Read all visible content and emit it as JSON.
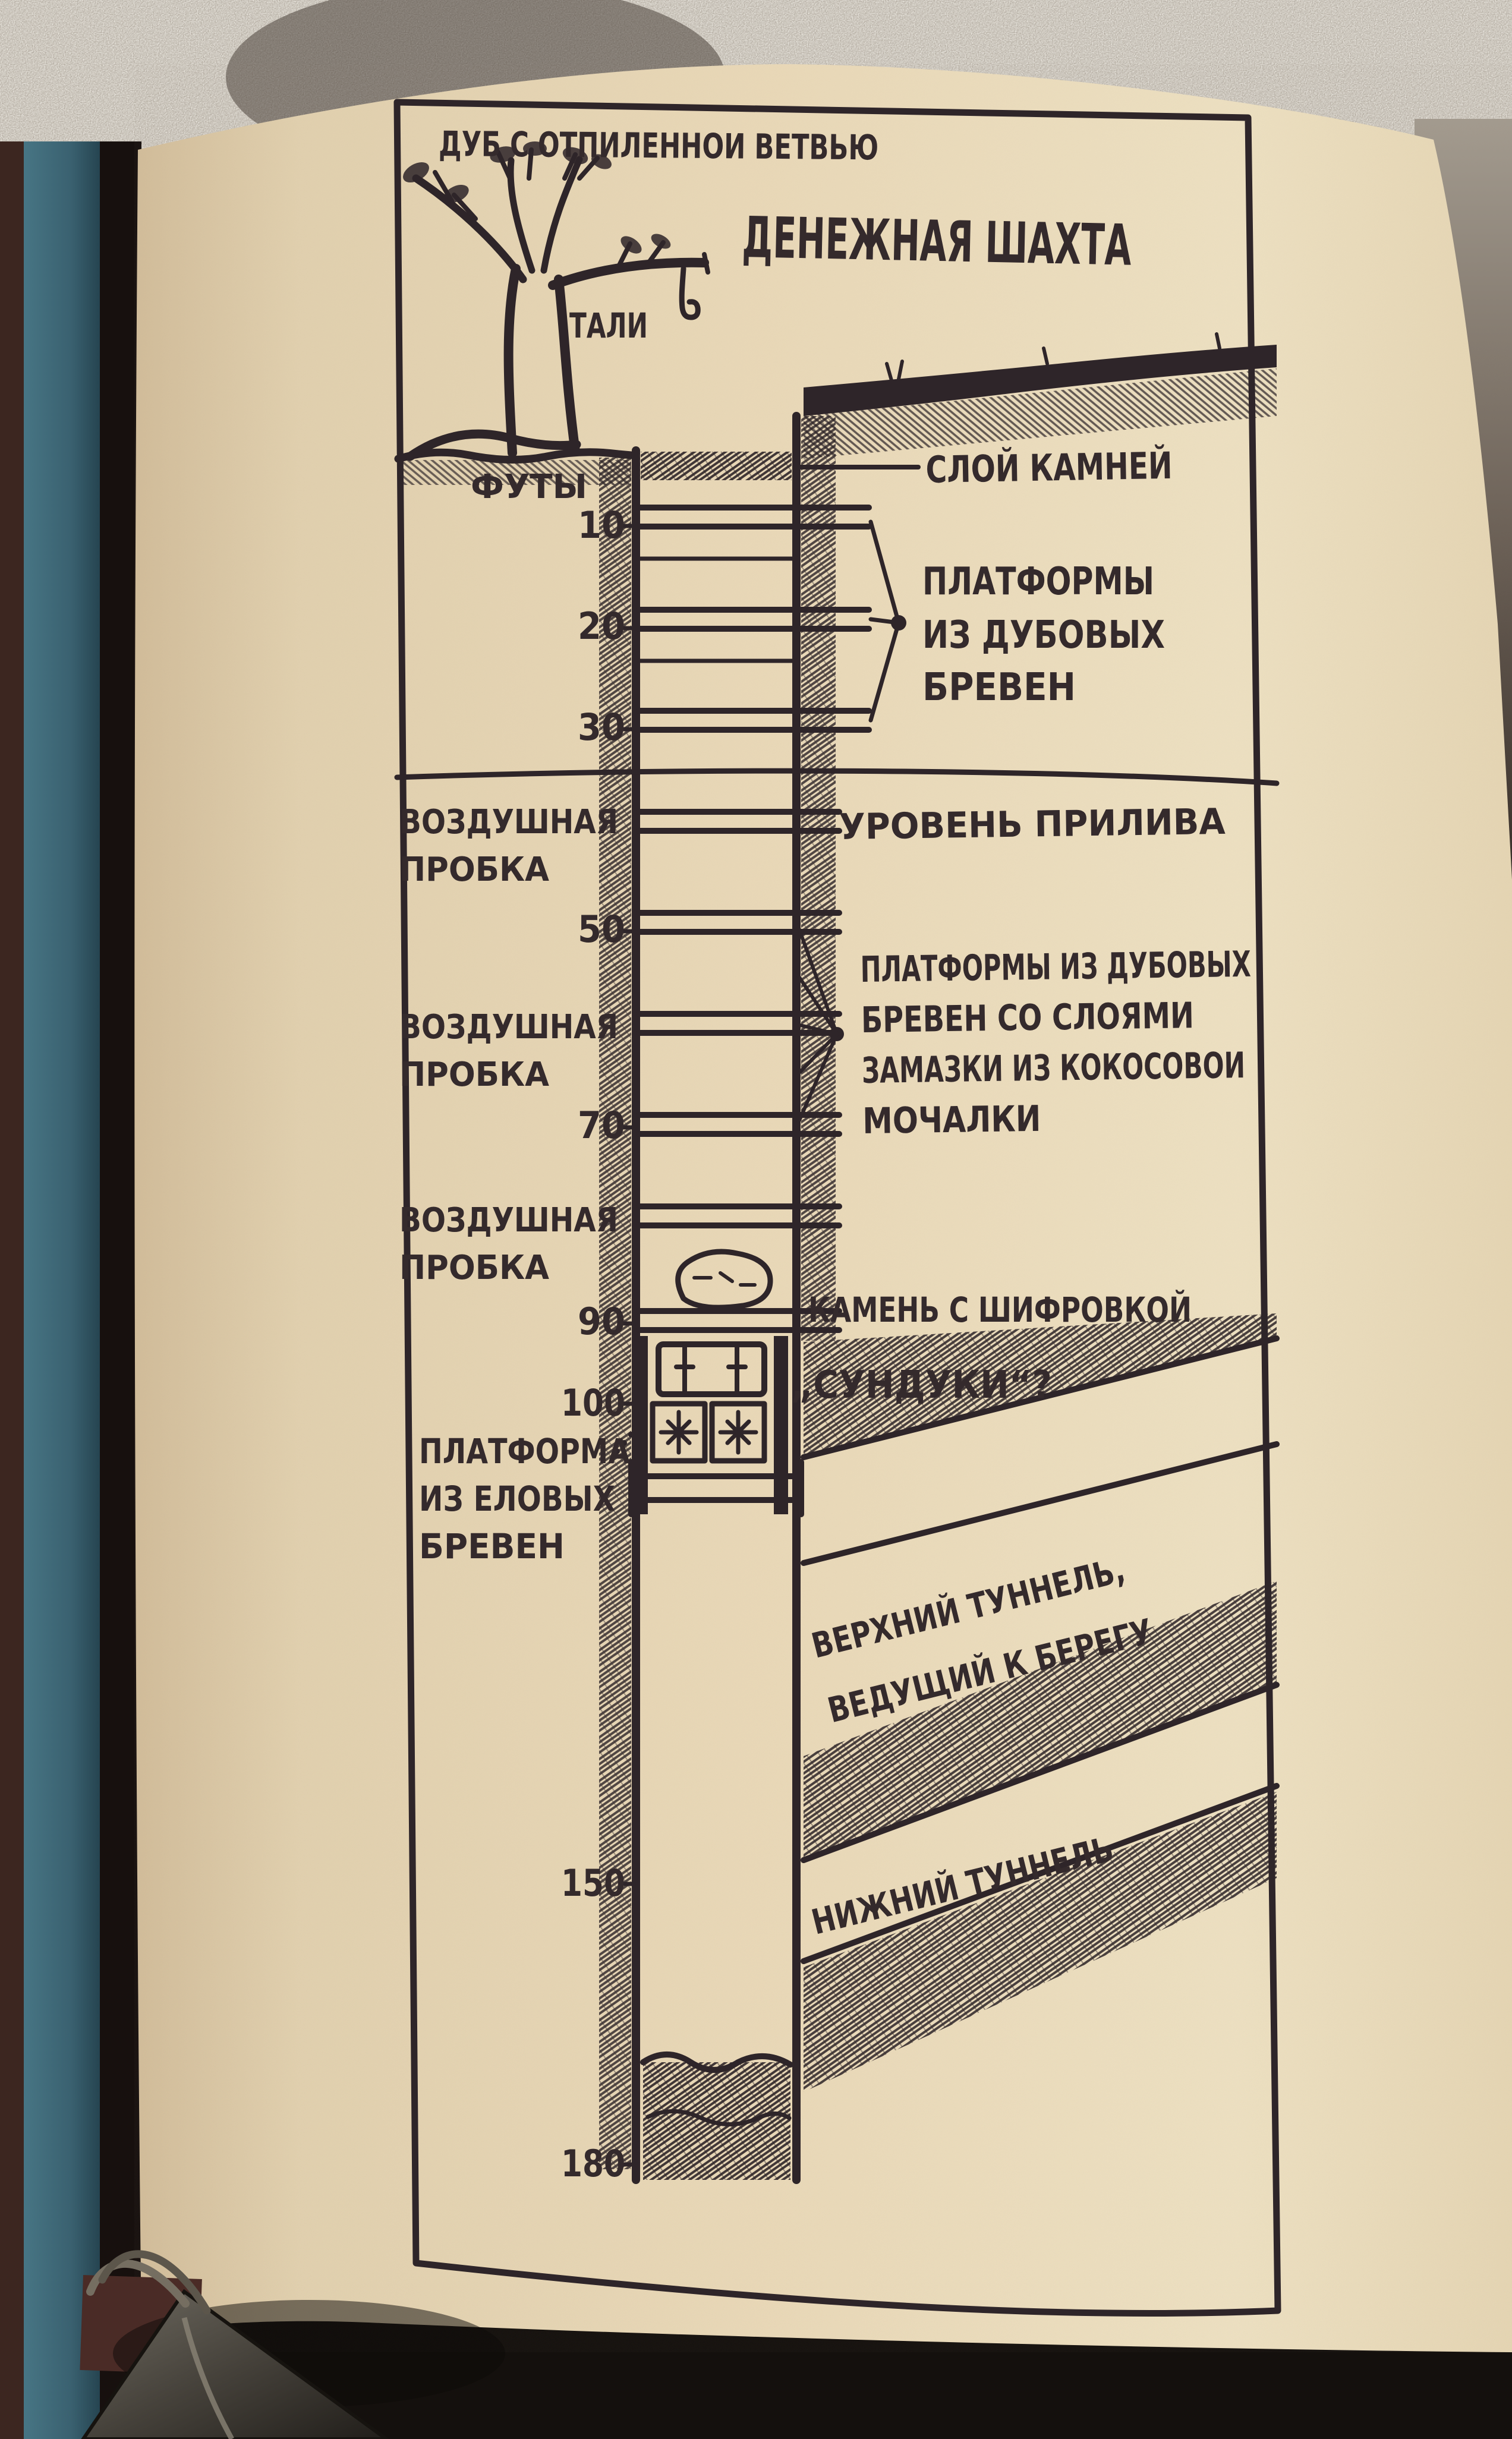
{
  "photo": {
    "backdrop_glitter": "#b5aea3",
    "backdrop_dark": "#1a1310",
    "cover_teal_light": "#477584",
    "cover_teal_dark": "#2a4c58",
    "cover_maroon": "#3c2620",
    "page_light": "#efe2c3",
    "page_mid": "#e7d8b7",
    "page_shadow": "#d2bd9a",
    "ink": "#2e2529",
    "clip_metal": "#555047"
  },
  "diagram": {
    "tree_label": "ДУБ С ОТПИЛЕННОИ ВЕТВЬЮ",
    "title": "ДЕНЕЖНАЯ ШАХТА",
    "tackle_label": "ТАЛИ",
    "feet_label": "ФУТЫ",
    "depth_ticks": [
      "10",
      "20",
      "30",
      "50",
      "70",
      "90",
      "100",
      "150",
      "180"
    ],
    "stone_layer_label": "СЛОЙ КАМНЕЙ",
    "oak_platforms_label": [
      "ПЛАТФОРМЫ",
      "ИЗ ДУБОВЫХ",
      "БРЕВЕН"
    ],
    "tide_level_label": "УРОВЕНЬ ПРИЛИВА",
    "air_pocket_label": [
      "ВОЗДУШНАЯ",
      "ПРОБКА"
    ],
    "putty_platforms_label": [
      "ПЛАТФОРМЫ ИЗ ДУБОВЫХ",
      "БРЕВЕН СО СЛОЯМИ",
      "ЗАМАЗКИ ИЗ КОКОСОВОИ",
      "МОЧАЛКИ"
    ],
    "cipher_stone_label": "КАМЕНЬ С ШИФРОВКОЙ",
    "chests_label": "„СУНДУКИ“?",
    "spruce_platform_label": [
      "ПЛАТФОРМА",
      "ИЗ ЕЛОВЫХ",
      "БРЕВЕН"
    ],
    "upper_tunnel_label": [
      "ВЕРХНИЙ ТУННЕЛЬ,",
      "ВЕДУЩИЙ К БЕРЕГУ"
    ],
    "lower_tunnel_label": "НИЖНИЙ ТУННЕЛЬ"
  }
}
